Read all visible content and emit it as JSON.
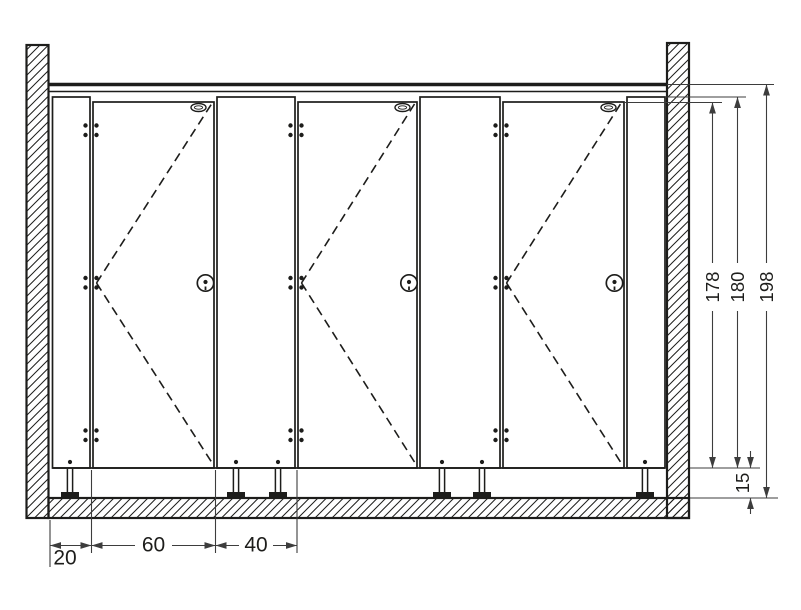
{
  "drawing": {
    "description_labels_visible_only": true,
    "colors": {
      "ink": "#1d1d1b",
      "dim_line": "#3d3d3d",
      "background": "#ffffff"
    },
    "dims": {
      "right": {
        "door_height": "178",
        "partition_height": "180",
        "total_height": "198",
        "floor_gap": "15"
      },
      "bottom": {
        "wall_to_door": "20",
        "door_width": "60",
        "partition_width": "40"
      }
    }
  }
}
